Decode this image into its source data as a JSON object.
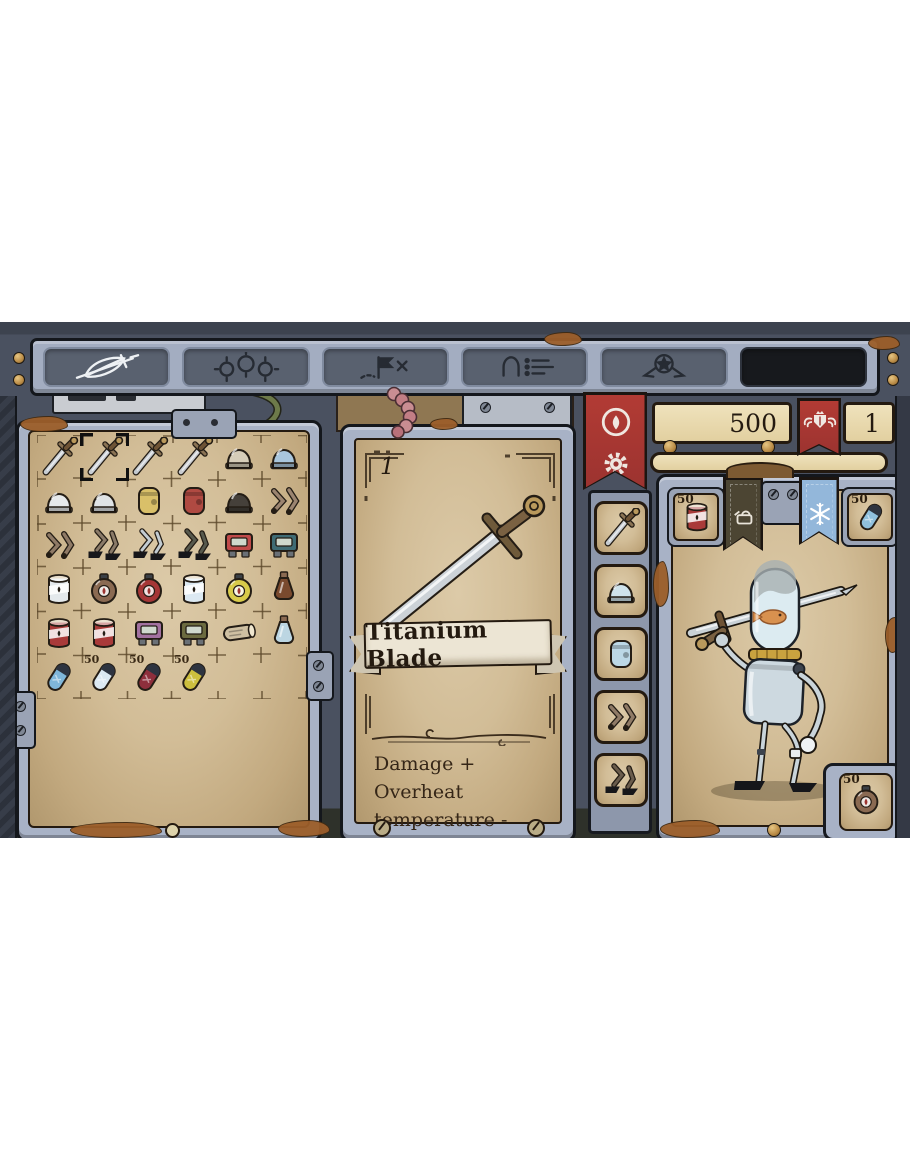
{
  "tabs": {
    "items": [
      {
        "id": "inventory",
        "icon": "feather-sword",
        "active": true,
        "blank": false
      },
      {
        "id": "gear",
        "icon": "gears",
        "active": false,
        "blank": false
      },
      {
        "id": "map",
        "icon": "map-flag",
        "active": false,
        "blank": false
      },
      {
        "id": "character",
        "icon": "robot-list",
        "active": false,
        "blank": false
      },
      {
        "id": "achievements",
        "icon": "star-medal",
        "active": false,
        "blank": false
      },
      {
        "id": "blank",
        "icon": "",
        "active": false,
        "blank": true
      }
    ]
  },
  "resources": {
    "oil": "500",
    "fame": "1"
  },
  "item_detail": {
    "count": "1",
    "name": "Titanium Blade",
    "stats": [
      "Damage +",
      "Overheat temperature -"
    ]
  },
  "equipment": {
    "slots": [
      {
        "id": "weapon",
        "kind": "sword",
        "color": "#c6ccd2"
      },
      {
        "id": "head",
        "kind": "helmet",
        "color": "#cfe3ec"
      },
      {
        "id": "body",
        "kind": "torso",
        "color": "#bcd8e6"
      },
      {
        "id": "arms",
        "kind": "arms",
        "color": "#8f7a66"
      },
      {
        "id": "legs",
        "kind": "legs",
        "color": "#6a5c4c"
      }
    ]
  },
  "quickslots": {
    "oil": {
      "count": "50",
      "kind": "can",
      "color": "#a93a39"
    },
    "coolant": {
      "count": "50",
      "kind": "pill",
      "color": "#8fc0dd"
    },
    "bomb": {
      "count": "50",
      "kind": "bomb",
      "color": "#8a6a52"
    }
  },
  "inventory": {
    "cols": 6,
    "rows": 6,
    "items": [
      {
        "row": 0,
        "col": 0,
        "name": "sword",
        "kind": "sword",
        "color": "#c6ccd2"
      },
      {
        "row": 0,
        "col": 1,
        "name": "titanium-blade",
        "kind": "sword",
        "color": "#c9ced4",
        "selected": true
      },
      {
        "row": 0,
        "col": 2,
        "name": "sword",
        "kind": "sword",
        "color": "#c2c8ce"
      },
      {
        "row": 0,
        "col": 3,
        "name": "dagger",
        "kind": "sword",
        "color": "#c9ccd0"
      },
      {
        "row": 0,
        "col": 4,
        "name": "fur-helmet",
        "kind": "helmet",
        "color": "#d6cdb9"
      },
      {
        "row": 0,
        "col": 5,
        "name": "dome-helmet",
        "kind": "helmet",
        "color": "#a9c6dd"
      },
      {
        "row": 1,
        "col": 0,
        "name": "steel-helmet",
        "kind": "helmet",
        "color": "#e6e9eb"
      },
      {
        "row": 1,
        "col": 1,
        "name": "visor-helmet",
        "kind": "helmet",
        "color": "#dfe3e6"
      },
      {
        "row": 1,
        "col": 2,
        "name": "gold-torso",
        "kind": "torso",
        "color": "#d9c069"
      },
      {
        "row": 1,
        "col": 3,
        "name": "red-torso",
        "kind": "torso",
        "color": "#b04a42"
      },
      {
        "row": 1,
        "col": 4,
        "name": "fur-hat",
        "kind": "helmet",
        "color": "#45403a"
      },
      {
        "row": 1,
        "col": 5,
        "name": "robot-arms",
        "kind": "arms",
        "color": "#9b8470"
      },
      {
        "row": 2,
        "col": 0,
        "name": "robot-arms",
        "kind": "arms",
        "color": "#8f7a66"
      },
      {
        "row": 2,
        "col": 1,
        "name": "robot-legs",
        "kind": "legs",
        "color": "#8a7a68"
      },
      {
        "row": 2,
        "col": 2,
        "name": "armored-legs",
        "kind": "legs",
        "color": "#c3ccd2"
      },
      {
        "row": 2,
        "col": 3,
        "name": "dark-legs",
        "kind": "legs",
        "color": "#57594d"
      },
      {
        "row": 2,
        "col": 4,
        "name": "red-module",
        "kind": "module",
        "color": "#c04a4a"
      },
      {
        "row": 2,
        "col": 5,
        "name": "teal-module",
        "kind": "module",
        "color": "#3f6b74"
      },
      {
        "row": 3,
        "col": 0,
        "name": "canister",
        "kind": "can",
        "color": "#e4e9ec"
      },
      {
        "row": 3,
        "col": 1,
        "name": "sack-bomb",
        "kind": "bomb",
        "color": "#8a6a52"
      },
      {
        "row": 3,
        "col": 2,
        "name": "fire-bomb",
        "kind": "bomb",
        "color": "#a53636"
      },
      {
        "row": 3,
        "col": 3,
        "name": "ice-grenade",
        "kind": "can",
        "color": "#dce9f2"
      },
      {
        "row": 3,
        "col": 4,
        "name": "emp-bomb",
        "kind": "bomb",
        "color": "#d8cb4a"
      },
      {
        "row": 3,
        "col": 5,
        "name": "oil-flask",
        "kind": "bottle",
        "color": "#7a4a2e"
      },
      {
        "row": 4,
        "col": 0,
        "name": "oil-can-small",
        "kind": "can",
        "color": "#a93a39"
      },
      {
        "row": 4,
        "col": 1,
        "name": "oil-can-large",
        "kind": "can",
        "color": "#a93a39"
      },
      {
        "row": 4,
        "col": 2,
        "name": "purple-module",
        "kind": "module",
        "color": "#a271a0"
      },
      {
        "row": 4,
        "col": 3,
        "name": "olive-module",
        "kind": "module",
        "color": "#6b6a3f"
      },
      {
        "row": 4,
        "col": 4,
        "name": "scroll",
        "kind": "scroll",
        "color": "#cfc0a2"
      },
      {
        "row": 4,
        "col": 5,
        "name": "crystal-flask",
        "kind": "bottle",
        "color": "#bcd6e2"
      },
      {
        "row": 5,
        "col": 0,
        "name": "coolant-capsule",
        "kind": "pill",
        "color": "#7fb6d9"
      },
      {
        "row": 5,
        "col": 1,
        "name": "white-capsule",
        "kind": "pill",
        "color": "#dce9f2",
        "count": "50"
      },
      {
        "row": 5,
        "col": 2,
        "name": "red-capsule",
        "kind": "pill",
        "color": "#8e2f3c",
        "count": "50"
      },
      {
        "row": 5,
        "col": 3,
        "name": "yellow-capsule",
        "kind": "pill",
        "color": "#cdbf3e",
        "count": "50"
      }
    ]
  }
}
